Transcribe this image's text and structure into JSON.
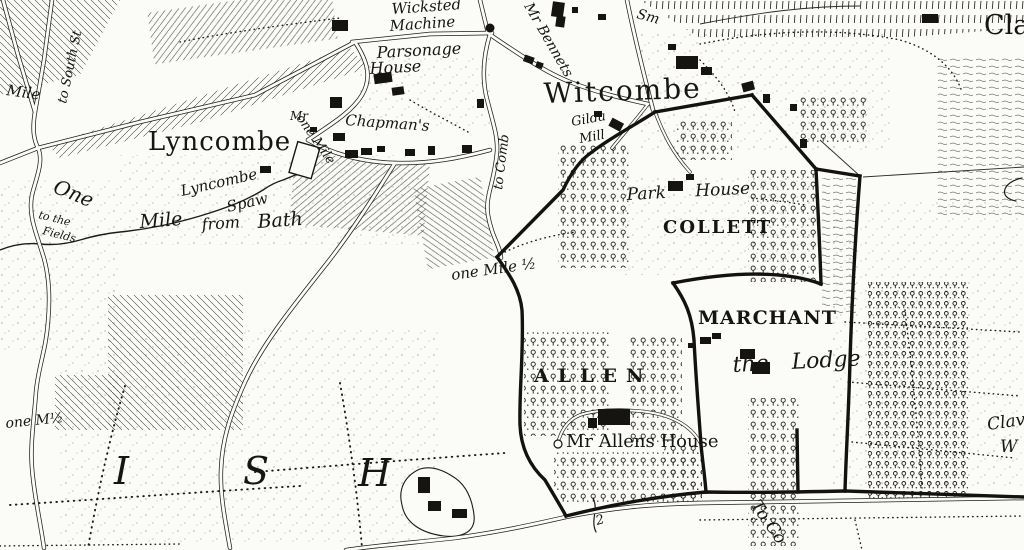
{
  "palette": {
    "ink": "#1c1b18",
    "paper": "#fbfbf8"
  },
  "labels": {
    "villages": {
      "lyncombe": "Lyncombe",
      "witcombe": "Witcombe",
      "claverton": "Clav"
    },
    "estates": {
      "collett": "COLLETT",
      "marchant": "MARCHANT",
      "allen": "ALLEN"
    },
    "houses": {
      "wicksted_line1": "Wicksted",
      "wicksted_line2": "Machine",
      "parsonage_line1": "Parsonage",
      "parsonage_line2": "House",
      "chapmans_prefix": "Mr",
      "chapmans": "Chapman's",
      "bennets": "Mr Bennets",
      "gilda_line1": "Gilda",
      "gilda_line2": "Mill",
      "park_house": "Park House",
      "the_lodge": "the Lodge",
      "allens_house": "Mr Allens House",
      "spaw_line1": "Lyncombe",
      "spaw_line2": "Spaw"
    },
    "distances": {
      "mile_edge": "Mile",
      "one": "One",
      "mile": "Mile",
      "from": "from",
      "bath": "Bath",
      "to_the": "to the",
      "fields": "Fields",
      "one_mile": "one Mile",
      "one_mile_half": "one Mile ½",
      "one_m_half": "one M½",
      "milestone": "2"
    },
    "routes": {
      "to_south": "to South St",
      "to_comb": "to Comb",
      "to_co": "To Co",
      "smallcombe": "Sm"
    },
    "parish_letters": [
      "I",
      "S",
      "H"
    ],
    "edge_labels": {
      "clav_wood_line1": "Clav",
      "clav_wood_line2": "W"
    }
  }
}
